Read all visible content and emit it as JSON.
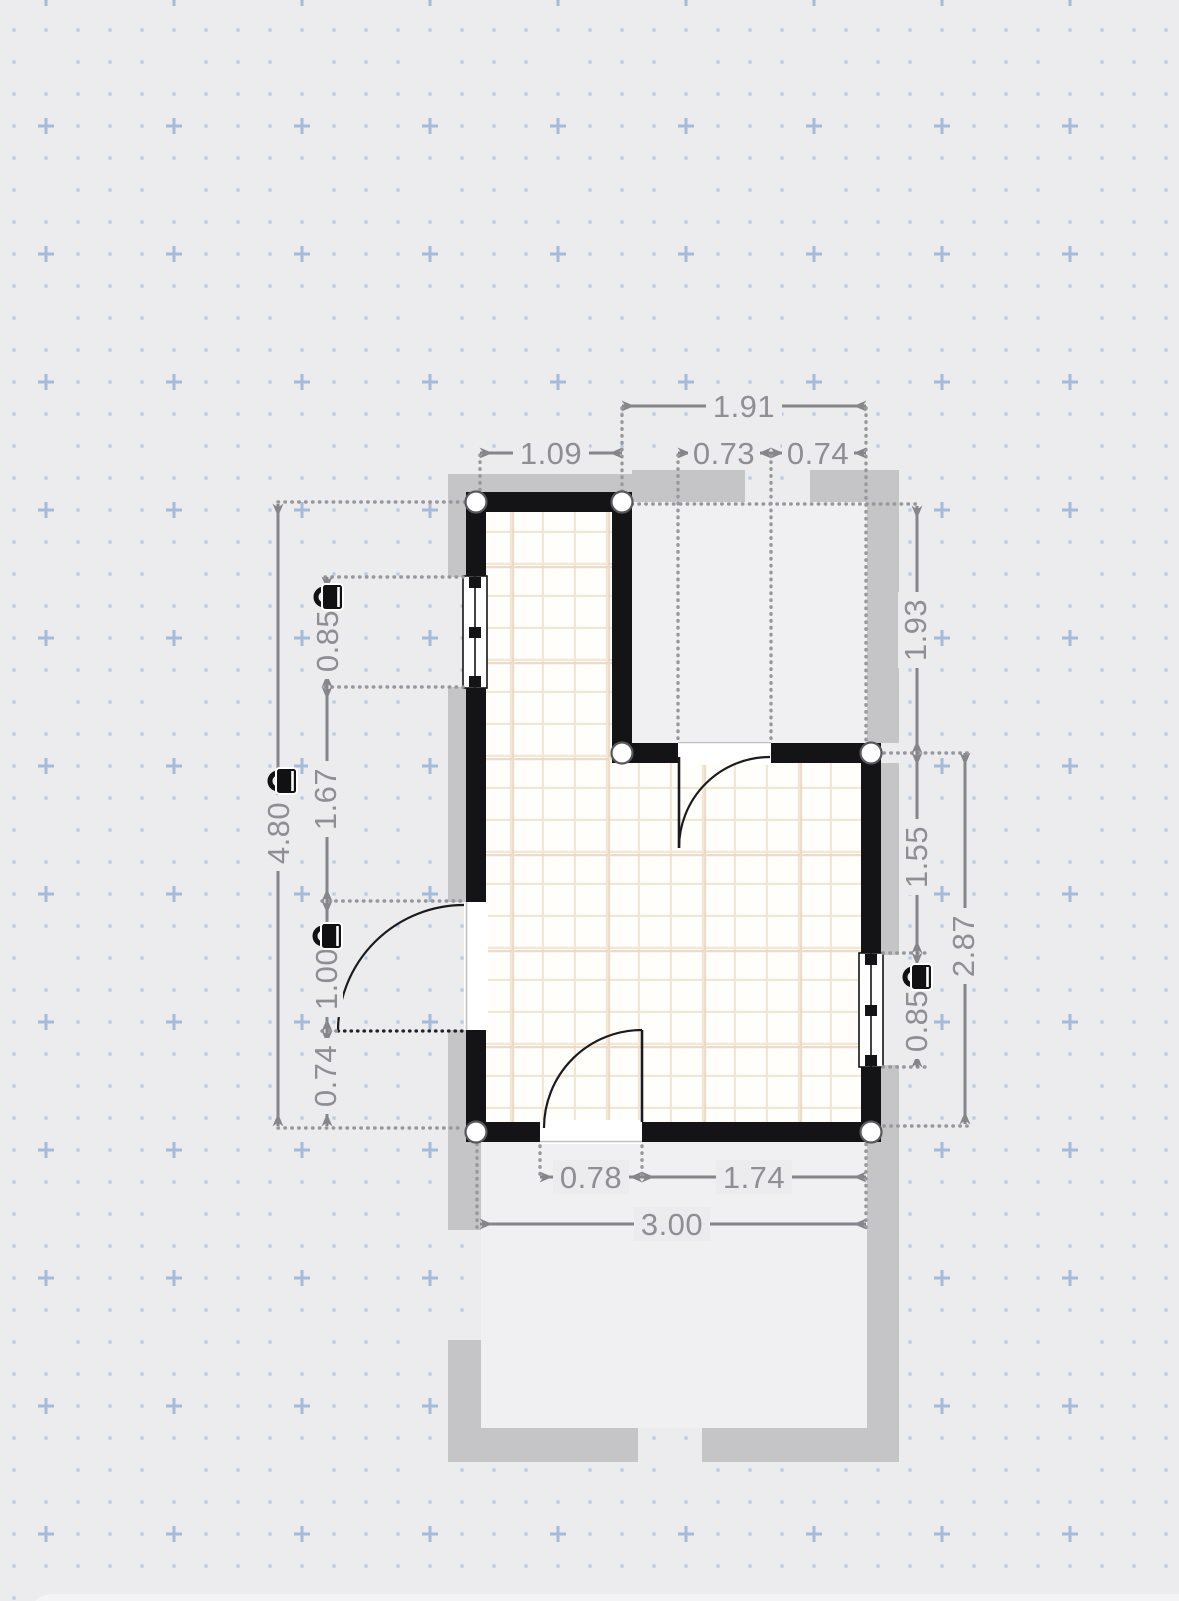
{
  "app": {
    "view": "floor-plan-editor-canvas",
    "units_shown": "decimal lengths"
  },
  "dimensions": {
    "top": {
      "total": "1.91",
      "segment_left": "1.09",
      "segment_door": "0.73",
      "segment_right": "0.74"
    },
    "left": {
      "total": "4.80",
      "window": "0.85",
      "middle": "1.67",
      "door": "1.00",
      "lower": "0.74"
    },
    "right": {
      "upper_room": "1.93",
      "middle": "1.55",
      "window": "0.85",
      "total": "2.87"
    },
    "bottom": {
      "door": "0.78",
      "segment_right": "1.74",
      "total": "3.00"
    }
  },
  "locked_dimensions": [
    "left.total",
    "left.window",
    "left.door",
    "right.window"
  ],
  "icons": {
    "lock": "padlock-icon"
  },
  "colors": {
    "canvas": "#ececee",
    "grid_dot": "#bfc8d8",
    "grid_cross": "#a6bbd7",
    "wall": "#141416",
    "exterior_band": "#c5c5c7",
    "adjacent_room_fill": "#f0f0f2",
    "floor": "#fffefb",
    "tile_line": "#f2e6d6",
    "tile_line_major": "#e9d6c1",
    "dimension_line": "#85858a",
    "dimension_text": "#8e8e93",
    "node_ring": "#58585c"
  }
}
